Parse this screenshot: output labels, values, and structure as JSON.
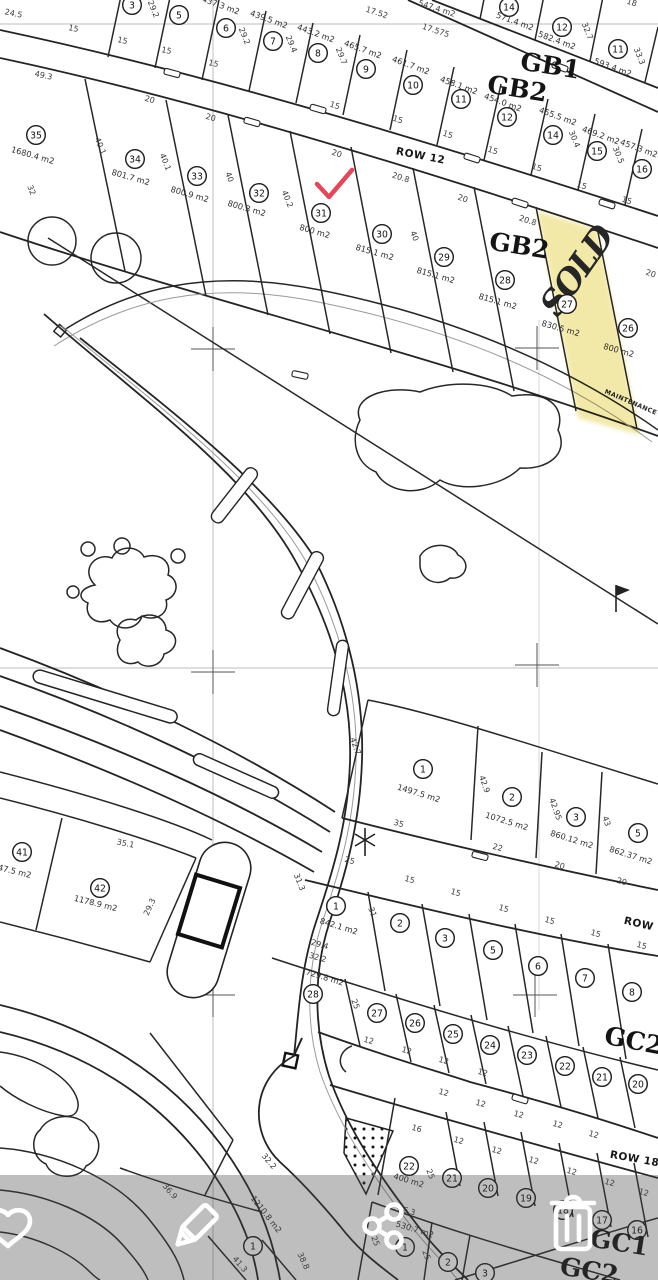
{
  "screen": {
    "width": 658,
    "height": 1280
  },
  "map": {
    "block_labels": [
      {
        "text": "GB1",
        "x": 549,
        "y": 74,
        "rot": 9
      },
      {
        "text": "GB2",
        "x": 516,
        "y": 97,
        "rot": 9
      },
      {
        "text": "GB2",
        "x": 518,
        "y": 254,
        "rot": 9
      },
      {
        "text": "GC2",
        "x": 632,
        "y": 1049,
        "rot": 11
      },
      {
        "text": "GC1",
        "x": 618,
        "y": 1251,
        "rot": 9
      },
      {
        "text": "GC2",
        "x": 588,
        "y": 1279,
        "rot": 9
      }
    ],
    "road_labels": [
      {
        "text": "ROW 12",
        "x": 420,
        "y": 159,
        "rot": 11
      },
      {
        "text": "ROW",
        "x": 638,
        "y": 927,
        "rot": 13
      },
      {
        "text": "ROW 18",
        "x": 634,
        "y": 1162,
        "rot": 10
      },
      {
        "text": "MAINTENANCE",
        "x": 630,
        "y": 404,
        "rot": 23,
        "tiny": true
      }
    ],
    "plots": [
      {
        "num": "14",
        "cx": 509,
        "cy": 7,
        "area": "571.4 m2",
        "ax": 514,
        "ay": 24,
        "arot": 20
      },
      {
        "num": "12",
        "cx": 562,
        "cy": 27,
        "area": "582.4 m2",
        "ax": 556,
        "ay": 43,
        "arot": 20
      },
      {
        "num": "11",
        "cx": 618,
        "cy": 49,
        "area": "593.4 m2",
        "ax": 612,
        "ay": 70,
        "arot": 20
      },
      {
        "num": "3",
        "cx": 132,
        "cy": 5
      },
      {
        "num": "5",
        "cx": 179,
        "cy": 15
      },
      {
        "num": "6",
        "cx": 226,
        "cy": 28,
        "area": "437.3 m2",
        "ax": 220,
        "ay": 8,
        "arot": 20
      },
      {
        "num": "7",
        "cx": 273,
        "cy": 41,
        "area": "439.5 m2",
        "ax": 268,
        "ay": 22,
        "arot": 20
      },
      {
        "num": "8",
        "cx": 318,
        "cy": 53,
        "area": "443.2 m2",
        "ax": 315,
        "ay": 36,
        "arot": 20
      },
      {
        "num": "9",
        "cx": 366,
        "cy": 69,
        "area": "465.7 m2",
        "ax": 362,
        "ay": 52,
        "arot": 20
      },
      {
        "num": "10",
        "cx": 413,
        "cy": 85,
        "area": "461.7 m2",
        "ax": 410,
        "ay": 68,
        "arot": 20
      },
      {
        "num": "11",
        "cx": 461,
        "cy": 99,
        "area": "458.1 m2",
        "ax": 458,
        "ay": 88,
        "arot": 20
      },
      {
        "num": "12",
        "cx": 507,
        "cy": 117,
        "area": "454.0 m2",
        "ax": 502,
        "ay": 105,
        "arot": 20
      },
      {
        "num": "14",
        "cx": 553,
        "cy": 135,
        "area": "455.5 m2",
        "ax": 557,
        "ay": 119,
        "arot": 20
      },
      {
        "num": "15",
        "cx": 597,
        "cy": 151,
        "area": "469.2 m2",
        "ax": 600,
        "ay": 138,
        "arot": 20
      },
      {
        "num": "16",
        "cx": 642,
        "cy": 169,
        "area": "457.3 m2",
        "ax": 638,
        "ay": 151,
        "arot": 20
      },
      {
        "num": "35",
        "cx": 36,
        "cy": 135,
        "area": "1680.4 m2",
        "ax": 32,
        "ay": 158,
        "arot": 16
      },
      {
        "num": "34",
        "cx": 135,
        "cy": 159,
        "area": "801.7 m2",
        "ax": 130,
        "ay": 180,
        "arot": 16
      },
      {
        "num": "33",
        "cx": 197,
        "cy": 176,
        "area": "800.9 m2",
        "ax": 189,
        "ay": 197,
        "arot": 16
      },
      {
        "num": "32",
        "cx": 259,
        "cy": 193,
        "area": "800.3 m2",
        "ax": 246,
        "ay": 211,
        "arot": 16
      },
      {
        "num": "31",
        "cx": 321,
        "cy": 213,
        "area": "800 m2",
        "ax": 314,
        "ay": 234,
        "arot": 16
      },
      {
        "num": "30",
        "cx": 382,
        "cy": 234,
        "area": "815.1 m2",
        "ax": 374,
        "ay": 255,
        "arot": 16
      },
      {
        "num": "29",
        "cx": 444,
        "cy": 257,
        "area": "815.1 m2",
        "ax": 435,
        "ay": 278,
        "arot": 16
      },
      {
        "num": "28",
        "cx": 505,
        "cy": 280,
        "area": "815.1 m2",
        "ax": 497,
        "ay": 304,
        "arot": 16
      },
      {
        "num": "27",
        "cx": 567,
        "cy": 304,
        "area": "830.5 m2",
        "ax": 560,
        "ay": 331,
        "arot": 16
      },
      {
        "num": "26",
        "cx": 628,
        "cy": 328,
        "area": "800 m2",
        "ax": 618,
        "ay": 353,
        "arot": 16
      },
      {
        "num": "1",
        "cx": 423,
        "cy": 769,
        "area": "1497.5 m2",
        "ax": 418,
        "ay": 796,
        "arot": 17
      },
      {
        "num": "2",
        "cx": 512,
        "cy": 797,
        "area": "1072.5 m2",
        "ax": 506,
        "ay": 824,
        "arot": 17
      },
      {
        "num": "3",
        "cx": 576,
        "cy": 817,
        "area": "860.12 m2",
        "ax": 571,
        "ay": 842,
        "arot": 17
      },
      {
        "num": "5",
        "cx": 638,
        "cy": 833,
        "area": "862.37 m2",
        "ax": 630,
        "ay": 858,
        "arot": 17
      },
      {
        "num": "41",
        "cx": 22,
        "cy": 852,
        "area": "47.5 m2",
        "ax": 14,
        "ay": 874,
        "arot": 14
      },
      {
        "num": "42",
        "cx": 100,
        "cy": 888,
        "area": "1178.9 m2",
        "ax": 95,
        "ay": 906,
        "arot": 14
      },
      {
        "num": "1",
        "cx": 336,
        "cy": 906,
        "area": "842.1 m2",
        "ax": 338,
        "ay": 929,
        "arot": 17
      },
      {
        "num": "2",
        "cx": 400,
        "cy": 923
      },
      {
        "num": "3",
        "cx": 445,
        "cy": 938
      },
      {
        "num": "5",
        "cx": 493,
        "cy": 950
      },
      {
        "num": "6",
        "cx": 538,
        "cy": 966
      },
      {
        "num": "7",
        "cx": 585,
        "cy": 978
      },
      {
        "num": "8",
        "cx": 632,
        "cy": 992
      },
      {
        "num": "28",
        "cx": 313,
        "cy": 994,
        "area": "729.8 m2",
        "ax": 324,
        "ay": 980,
        "arot": 17
      },
      {
        "num": "27",
        "cx": 377,
        "cy": 1013
      },
      {
        "num": "26",
        "cx": 415,
        "cy": 1023
      },
      {
        "num": "25",
        "cx": 453,
        "cy": 1034
      },
      {
        "num": "24",
        "cx": 490,
        "cy": 1045
      },
      {
        "num": "23",
        "cx": 527,
        "cy": 1055
      },
      {
        "num": "22",
        "cx": 565,
        "cy": 1066
      },
      {
        "num": "21",
        "cx": 602,
        "cy": 1077
      },
      {
        "num": "20",
        "cx": 638,
        "cy": 1084
      },
      {
        "num": "22",
        "cx": 409,
        "cy": 1166,
        "area": "400 m2",
        "ax": 408,
        "ay": 1183,
        "arot": 17
      },
      {
        "num": "21",
        "cx": 452,
        "cy": 1178
      },
      {
        "num": "20",
        "cx": 488,
        "cy": 1188
      },
      {
        "num": "19",
        "cx": 526,
        "cy": 1198
      },
      {
        "num": "18",
        "cx": 563,
        "cy": 1210
      },
      {
        "num": "17",
        "cx": 602,
        "cy": 1220
      },
      {
        "num": "16",
        "cx": 637,
        "cy": 1230
      },
      {
        "num": "1",
        "cx": 405,
        "cy": 1247,
        "area": "530.7 m2",
        "ax": 414,
        "ay": 1232,
        "arot": 17
      },
      {
        "num": "2",
        "cx": 448,
        "cy": 1262
      },
      {
        "num": "3",
        "cx": 485,
        "cy": 1273
      },
      {
        "num": "1",
        "cx": 253,
        "cy": 1246,
        "area": "1210.8 m2",
        "ax": 264,
        "ay": 1216,
        "arot": 52
      }
    ],
    "dims": [
      {
        "t": "24.5",
        "x": 13,
        "y": 16,
        "r": 12
      },
      {
        "t": "15",
        "x": 73,
        "y": 31,
        "r": 12
      },
      {
        "t": "15",
        "x": 122,
        "y": 43,
        "r": 12
      },
      {
        "t": "15",
        "x": 166,
        "y": 53,
        "r": 12
      },
      {
        "t": "15",
        "x": 213,
        "y": 66,
        "r": 12
      },
      {
        "t": "15",
        "x": 334,
        "y": 108,
        "r": 18
      },
      {
        "t": "15",
        "x": 397,
        "y": 122,
        "r": 18
      },
      {
        "t": "15",
        "x": 447,
        "y": 137,
        "r": 18
      },
      {
        "t": "15",
        "x": 492,
        "y": 153,
        "r": 18
      },
      {
        "t": "15",
        "x": 536,
        "y": 170,
        "r": 18
      },
      {
        "t": "15",
        "x": 581,
        "y": 188,
        "r": 18
      },
      {
        "t": "15",
        "x": 626,
        "y": 203,
        "r": 18
      },
      {
        "t": "49.3",
        "x": 43,
        "y": 78,
        "r": 12
      },
      {
        "t": "20",
        "x": 149,
        "y": 102,
        "r": 16
      },
      {
        "t": "20",
        "x": 210,
        "y": 120,
        "r": 16
      },
      {
        "t": "20",
        "x": 336,
        "y": 156,
        "r": 18
      },
      {
        "t": "20",
        "x": 462,
        "y": 201,
        "r": 18
      },
      {
        "t": "20",
        "x": 650,
        "y": 276,
        "r": 18
      },
      {
        "t": "20.8",
        "x": 400,
        "y": 180,
        "r": 18
      },
      {
        "t": "20.8",
        "x": 527,
        "y": 223,
        "r": 18
      },
      {
        "t": "29.2",
        "x": 151,
        "y": 10,
        "r": 68
      },
      {
        "t": "29.2",
        "x": 242,
        "y": 37,
        "r": 68
      },
      {
        "t": "29.4",
        "x": 289,
        "y": 45,
        "r": 68
      },
      {
        "t": "29.7",
        "x": 339,
        "y": 57,
        "r": 68
      },
      {
        "t": "30.4",
        "x": 572,
        "y": 140,
        "r": 68
      },
      {
        "t": "30.5",
        "x": 616,
        "y": 156,
        "r": 68
      },
      {
        "t": "32.7",
        "x": 585,
        "y": 32,
        "r": 68
      },
      {
        "t": "33.3",
        "x": 637,
        "y": 57,
        "r": 68
      },
      {
        "t": "18",
        "x": 631,
        "y": 5,
        "r": 18
      },
      {
        "t": "17.52",
        "x": 376,
        "y": 15,
        "r": 18
      },
      {
        "t": "17.575",
        "x": 435,
        "y": 33,
        "r": 18
      },
      {
        "t": "547.4 m2",
        "x": 436,
        "y": 11,
        "r": 18
      },
      {
        "t": "40.1",
        "x": 98,
        "y": 147,
        "r": 68
      },
      {
        "t": "40.1",
        "x": 163,
        "y": 163,
        "r": 68
      },
      {
        "t": "40",
        "x": 227,
        "y": 178,
        "r": 68
      },
      {
        "t": "40.2",
        "x": 285,
        "y": 200,
        "r": 68
      },
      {
        "t": "40",
        "x": 412,
        "y": 237,
        "r": 68
      },
      {
        "t": "32",
        "x": 29,
        "y": 191,
        "r": 68
      },
      {
        "t": "42.7",
        "x": 353,
        "y": 747,
        "r": 70
      },
      {
        "t": "42.9",
        "x": 482,
        "y": 785,
        "r": 70
      },
      {
        "t": "42.95",
        "x": 553,
        "y": 810,
        "r": 70
      },
      {
        "t": "43",
        "x": 604,
        "y": 822,
        "r": 70
      },
      {
        "t": "35",
        "x": 398,
        "y": 826,
        "r": 16
      },
      {
        "t": "22",
        "x": 497,
        "y": 850,
        "r": 16
      },
      {
        "t": "20",
        "x": 559,
        "y": 868,
        "r": 16
      },
      {
        "t": "20",
        "x": 621,
        "y": 884,
        "r": 16
      },
      {
        "t": "25",
        "x": 349,
        "y": 863,
        "r": 16
      },
      {
        "t": "15",
        "x": 409,
        "y": 882,
        "r": 16
      },
      {
        "t": "35.1",
        "x": 125,
        "y": 846,
        "r": 12
      },
      {
        "t": "29.3",
        "x": 152,
        "y": 908,
        "r": -65
      },
      {
        "t": "31.3",
        "x": 297,
        "y": 883,
        "r": 68
      },
      {
        "t": "31",
        "x": 370,
        "y": 913,
        "r": 68
      },
      {
        "t": "15",
        "x": 455,
        "y": 895,
        "r": 16
      },
      {
        "t": "15",
        "x": 503,
        "y": 911,
        "r": 16
      },
      {
        "t": "15",
        "x": 549,
        "y": 923,
        "r": 16
      },
      {
        "t": "15",
        "x": 595,
        "y": 936,
        "r": 16
      },
      {
        "t": "15",
        "x": 641,
        "y": 948,
        "r": 16
      },
      {
        "t": "29.4",
        "x": 319,
        "y": 947,
        "r": 16
      },
      {
        "t": "32.2",
        "x": 317,
        "y": 960,
        "r": 16
      },
      {
        "t": "25",
        "x": 353,
        "y": 1005,
        "r": 68
      },
      {
        "t": "12",
        "x": 368,
        "y": 1043,
        "r": 16
      },
      {
        "t": "12",
        "x": 406,
        "y": 1053,
        "r": 16
      },
      {
        "t": "12",
        "x": 443,
        "y": 1063,
        "r": 16
      },
      {
        "t": "12",
        "x": 482,
        "y": 1075,
        "r": 16
      },
      {
        "t": "12",
        "x": 443,
        "y": 1095,
        "r": 16
      },
      {
        "t": "12",
        "x": 480,
        "y": 1106,
        "r": 16
      },
      {
        "t": "12",
        "x": 518,
        "y": 1117,
        "r": 16
      },
      {
        "t": "12",
        "x": 557,
        "y": 1127,
        "r": 16
      },
      {
        "t": "12",
        "x": 593,
        "y": 1137,
        "r": 16
      },
      {
        "t": "16",
        "x": 416,
        "y": 1131,
        "r": 16
      },
      {
        "t": "12",
        "x": 458,
        "y": 1143,
        "r": 16
      },
      {
        "t": "12",
        "x": 496,
        "y": 1153,
        "r": 16
      },
      {
        "t": "12",
        "x": 533,
        "y": 1163,
        "r": 16
      },
      {
        "t": "12",
        "x": 571,
        "y": 1174,
        "r": 16
      },
      {
        "t": "12",
        "x": 609,
        "y": 1185,
        "r": 16
      },
      {
        "t": "12",
        "x": 643,
        "y": 1195,
        "r": 16
      },
      {
        "t": "25",
        "x": 428,
        "y": 1175,
        "r": 68
      },
      {
        "t": "26.3",
        "x": 406,
        "y": 1213,
        "r": 16
      },
      {
        "t": "25",
        "x": 373,
        "y": 1242,
        "r": 68
      },
      {
        "t": "25",
        "x": 424,
        "y": 1256,
        "r": 68
      },
      {
        "t": "36.9",
        "x": 168,
        "y": 1193,
        "r": 50
      },
      {
        "t": "41.3",
        "x": 238,
        "y": 1266,
        "r": 50
      },
      {
        "t": "38.8",
        "x": 301,
        "y": 1262,
        "r": 65
      },
      {
        "t": "32.2",
        "x": 267,
        "y": 1163,
        "r": 50
      }
    ],
    "annotations": {
      "sold_text": "SOLD",
      "sold_plot": "27",
      "check_plot": "31",
      "marker_color": "#e2485c",
      "highlight_color": "#f0e59a"
    }
  },
  "toolbar": {
    "background": "rgba(70,70,70,0.35)",
    "icons": [
      {
        "name": "favorite-icon"
      },
      {
        "name": "edit-icon"
      },
      {
        "name": "share-icon"
      },
      {
        "name": "delete-icon"
      }
    ]
  }
}
